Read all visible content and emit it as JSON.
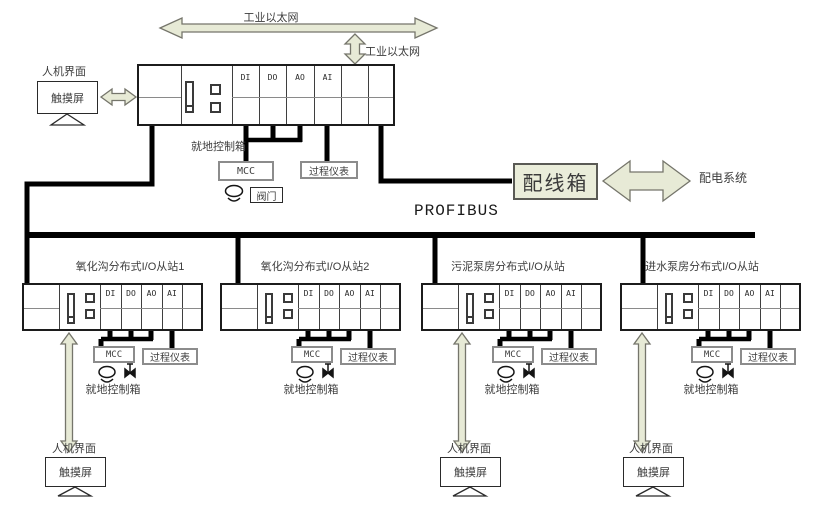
{
  "labels": {
    "industrial_ethernet": "工业以太网",
    "profibus": "PROFIBUS",
    "hmi": "人机界面",
    "touchscreen": "触摸屏",
    "local_control_box": "就地控制箱",
    "mcc": "MCC",
    "valve": "阀门",
    "process_instruments": "过程仪表",
    "wiring_box": "配线箱",
    "power_distribution_system": "配电系统"
  },
  "plc_modules": [
    "DI",
    "DO",
    "AO",
    "AI"
  ],
  "stations": [
    {
      "title": "氧化沟分布式I/O从站1"
    },
    {
      "title": "氧化沟分布式I/O从站2"
    },
    {
      "title": "污泥泵房分布式I/O从站"
    },
    {
      "title": "进水泵房分布式I/O从站"
    }
  ],
  "colors": {
    "arrow_fill": "#e7ead6",
    "arrow_stroke": "#75756b",
    "line": "#000000",
    "wiring_box_fill": "#eaedda"
  }
}
